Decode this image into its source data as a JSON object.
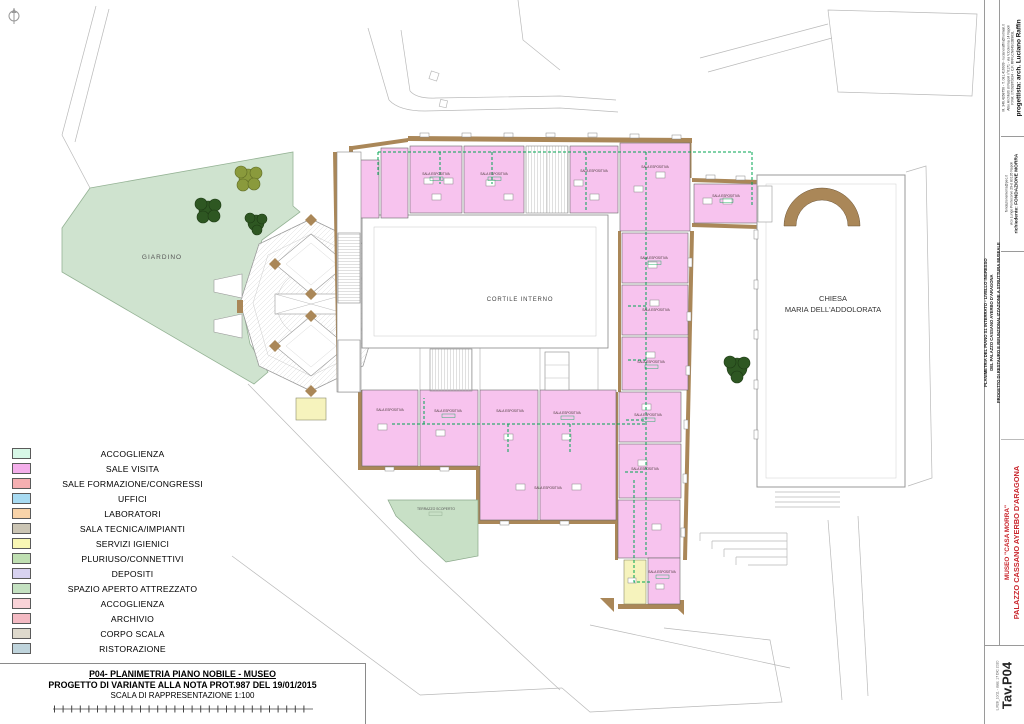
{
  "page": {
    "background": "#ffffff"
  },
  "plan": {
    "garden_label": "GIARDINO",
    "courtyard_label": "CORTILE INTERNO",
    "church_label_line1": "CHIESA",
    "church_label_line2": "MARIA DELL'ADDOLORATA",
    "terrace_label": "TERRAZZO SCOPERTO",
    "room_label": "SALA ESPOSITIVA",
    "colors": {
      "exhibit_room": "#f7c3ee",
      "wall_poche": "#aa8758",
      "garden": "#cfe3cf",
      "terrace": "#c8e0c6",
      "wc_room": "#f6f3bd",
      "visit_route": "#00a651"
    }
  },
  "legend": {
    "items": [
      {
        "label": "ACCOGLIENZA",
        "color": "#d7f7e6"
      },
      {
        "label": "SALE VISITA",
        "color": "#f3aeea"
      },
      {
        "label": "SALE FORMAZIONE/CONGRESSI",
        "color": "#f5afb1"
      },
      {
        "label": "UFFICI",
        "color": "#a8dbf2"
      },
      {
        "label": "LABORATORI",
        "color": "#f8d3a9"
      },
      {
        "label": "SALA TECNICA/IMPIANTI",
        "color": "#cbc5b4"
      },
      {
        "label": "SERVIZI IGIENICI",
        "color": "#f8f6b4"
      },
      {
        "label": "PLURIUSO/CONNETTIVI",
        "color": "#bfdfb2"
      },
      {
        "label": "DEPOSITI",
        "color": "#d8d2f0"
      },
      {
        "label": "SPAZIO APERTO ATTREZZATO",
        "color": "#c4e1c1"
      },
      {
        "label": "ACCOGLIENZA",
        "color": "#f9d3d8"
      },
      {
        "label": "ARCHIVIO",
        "color": "#f3bac3"
      },
      {
        "label": "CORPO SCALA",
        "color": "#ded9cc"
      },
      {
        "label": "RISTORAZIONE",
        "color": "#bfd4dc"
      }
    ]
  },
  "title_block": {
    "line1": "P04- PLANIMETRIA PIANO NOBILE - MUSEO",
    "line2": "PROGETTO DI VARIANTE ALLA NOTA PROT.987 DEL 19/01/2015",
    "line3": "SCALA DI RAPPRESENTAZIONE 1:100"
  },
  "sidebar": {
    "designer": {
      "title": "progettista: arch. Luciano Raffin",
      "small1": "M. 346.4268756 - T. 081.416939 - lucianoraffin@hotmail.it",
      "small2": "Albo Architetti di Napoli n°6171 - via V.Colonna 14 Napoli",
      "small3": "P.IVA: 07092870634 - C.F. RFFLCN64S02B963L"
    },
    "client": {
      "line_pec": "fondazionemorra@pec.it",
      "line_address": "vico Lungo Pontecorvo 29-d 80135 Napoli",
      "title": "richiedente: FONDAZIONE MORRA"
    },
    "project": {
      "line1": "PROGETTO DI RESTAURO E RIFUNZIONALIZZAZIONE A STRUTTURA MUSEALE",
      "line2": "DEL PALAZZO CASSANO AYERBO D'ARAGONA",
      "line3": "PLANIMETRIA DEL PIANO S1 INTERRATO - LIVELLO INGRESSO"
    },
    "building": {
      "title": "PALAZZO CASSANO AYERBO D'ARAGONA",
      "subtitle": "MUSEO \"CASA MORRA\"",
      "color": "#c9252c"
    },
    "sheet": {
      "number": "Tav.P04",
      "note": "L.R28_10/11 - data: 17 DIC 2020"
    }
  }
}
